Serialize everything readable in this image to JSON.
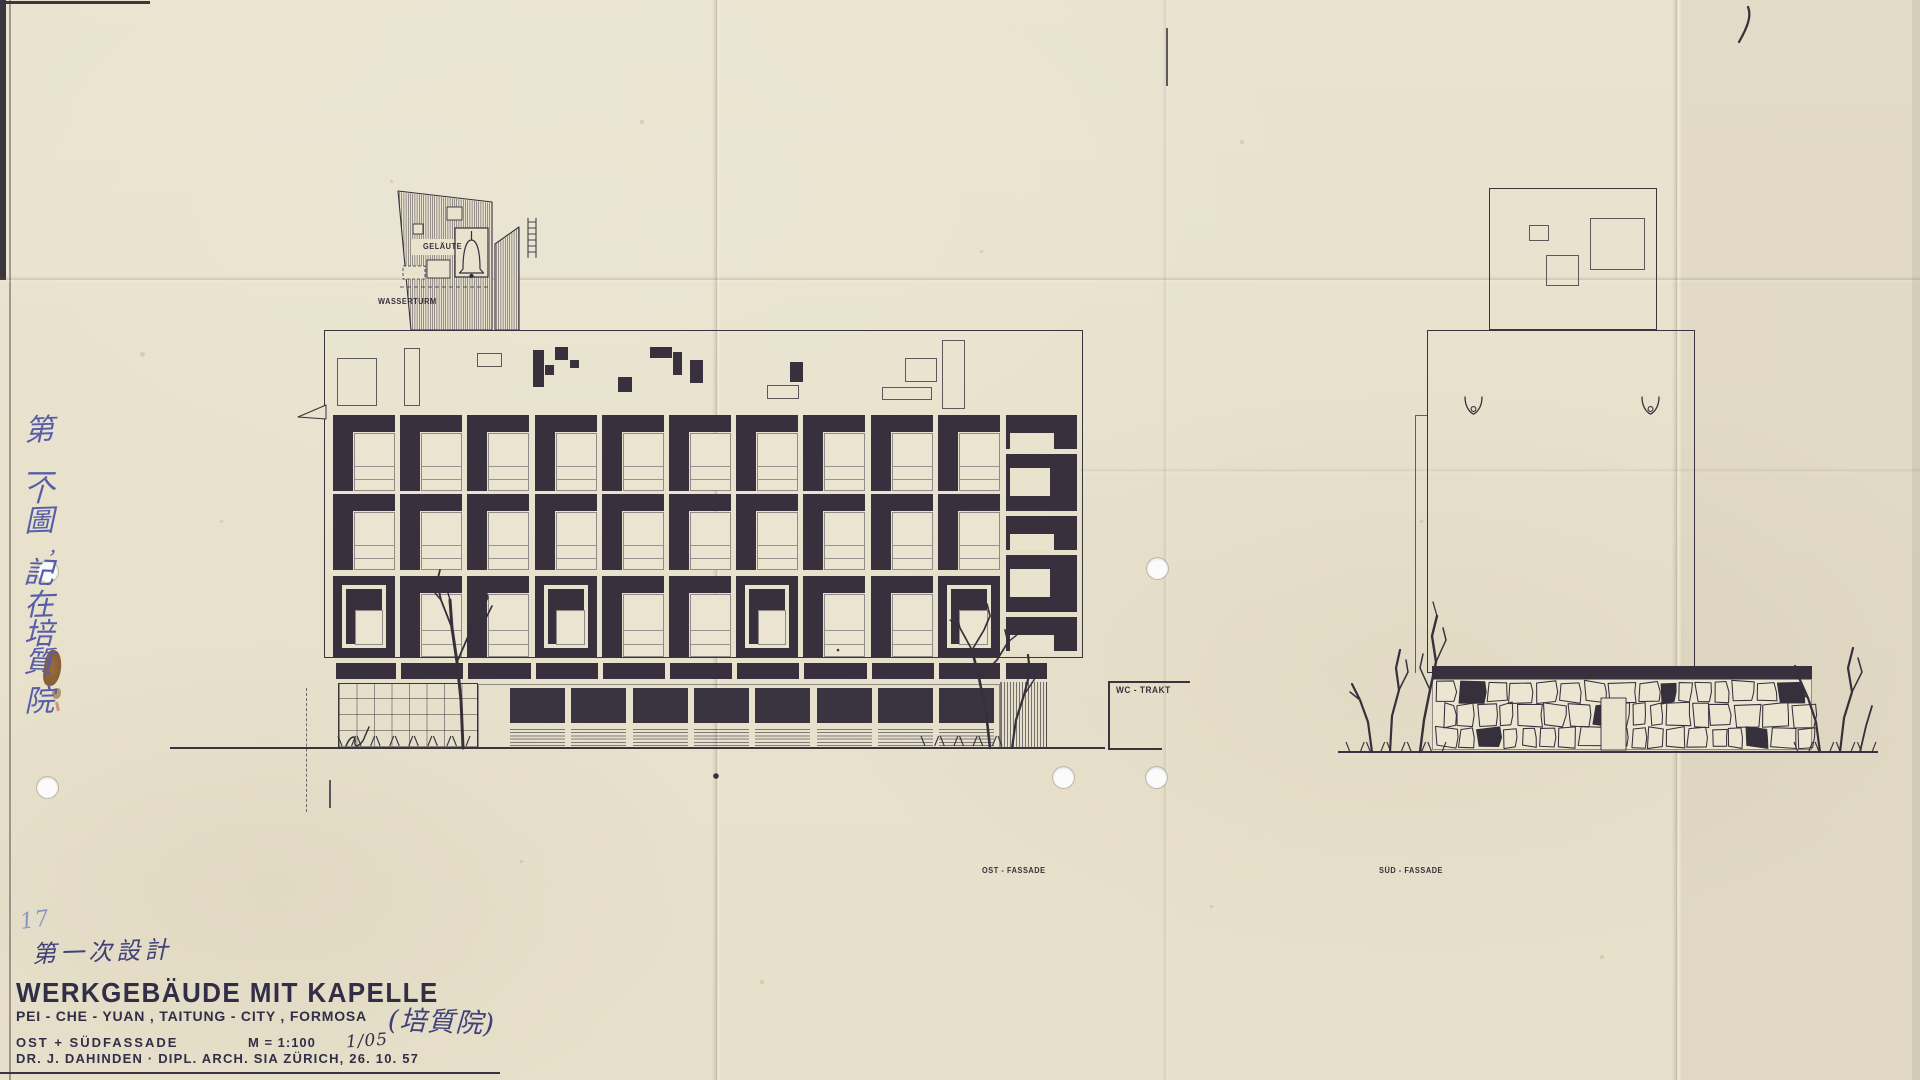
{
  "sheet": {
    "handwritten_number": "17",
    "handwritten_note": "第一次設計",
    "side_note_vertical": "第一个圖，記在培質院",
    "side_note_chars": [
      "第",
      "一",
      "个",
      "圖",
      "，",
      "記",
      "在",
      "培",
      "質",
      "院"
    ]
  },
  "title_block": {
    "title": "WERKGEBÄUDE MIT KAPELLE",
    "location_line": "PEI - CHE - YUAN , TAITUNG - CITY , FORMOSA",
    "location_handwritten": "(培質院)",
    "views_label": "OST + SÜDFASSADE",
    "scale_label": "M = 1:100",
    "sheet_ref": "1/05",
    "credit_line": "DR. J. DAHINDEN  ·  DIPL. ARCH. SIA  ZÜRICH, 26. 10. 57"
  },
  "drawing_labels": {
    "bell_cage": "GELÄUTE",
    "water_tower": "WASSERTURM",
    "wc_wing": "WC - TRAKT",
    "east_elevation": "OST - FASSADE",
    "south_elevation": "SÜD - FASSADE"
  },
  "colors": {
    "paper": "#e9e2cd",
    "ink": "#36303c",
    "facade_fill": "#38313d",
    "hand_ink_blue": "#3f4178",
    "pencil_blue": "#8d96c6",
    "stain_brown": "#7a4a20"
  },
  "elevation_east": {
    "cell_rows": 3,
    "window_columns": 10,
    "framed_square_columns": [
      1,
      4,
      7,
      10
    ],
    "right_stack_cells": 5,
    "ground_window_units": 8,
    "has_bell_tower": true,
    "has_water_tower": true
  },
  "elevation_south": {
    "roof_box_squares": 3,
    "rain_spouts": 2,
    "rubble_stone_wall": true,
    "has_door": true
  }
}
